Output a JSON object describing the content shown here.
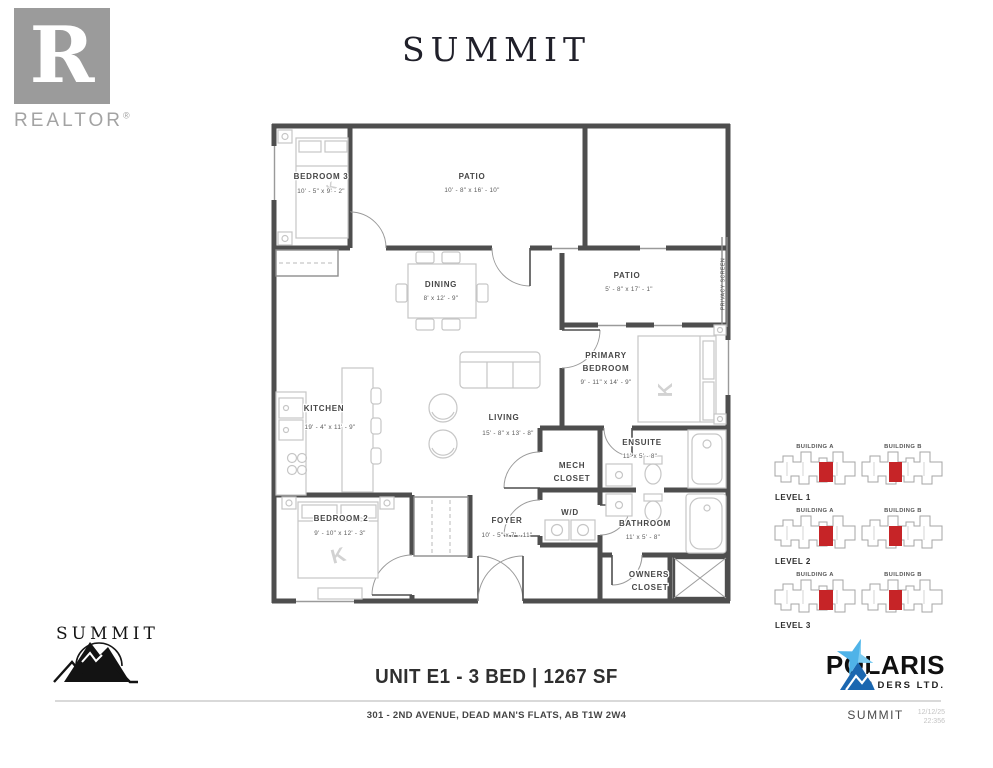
{
  "header": {
    "realtor": {
      "monogram": "R",
      "wordmark": "REALTOR",
      "registered": "®"
    },
    "title": "SUMMIT"
  },
  "colors": {
    "wall_gray": "#4e4e4e",
    "furniture_gray": "#c6c6c6",
    "realtor_gray": "#9b9b9b",
    "polaris_star_blue": "#4fb3e8",
    "polaris_mountain_blue": "#1b67b0"
  },
  "floor_plan": {
    "bed_mark": "K",
    "privacy_screen_label": "PRIVACY SCREEN",
    "rooms": {
      "bedroom3": {
        "name": "BEDROOM 3",
        "dims": "10' - 5\" x 9' - 2\""
      },
      "patio_top": {
        "name": "PATIO",
        "dims": "10' - 8\" x 16' - 10\""
      },
      "dining": {
        "name": "DINING",
        "dims": "8' x 12' - 9\""
      },
      "patio_side": {
        "name": "PATIO",
        "dims": "5' - 8\" x 17' - 1\""
      },
      "primary_bedroom": {
        "line1": "PRIMARY",
        "line2": "BEDROOM",
        "dims": "9' - 11\" x 14' - 9\""
      },
      "kitchen": {
        "name": "KITCHEN",
        "dims": "19' - 4\" x 11' - 9\""
      },
      "living": {
        "name": "LIVING",
        "dims": "15' - 8\" x 13' - 8\""
      },
      "ensuite": {
        "name": "ENSUITE",
        "dims": "11' x 5' - 8\""
      },
      "mech_closet": {
        "line1": "MECH",
        "line2": "CLOSET"
      },
      "wd": {
        "name": "W/D"
      },
      "bathroom": {
        "name": "BATHROOM",
        "dims": "11' x 5' - 8\""
      },
      "bedroom2": {
        "name": "BEDROOM 2",
        "dims": "9' - 10\" x 12' - 3\""
      },
      "foyer": {
        "name": "FOYER",
        "dims": "10' - 5\" x 7' - 11\""
      },
      "owners_closet": {
        "line1": "OWNERS",
        "line2": "CLOSET"
      }
    }
  },
  "key_plan": {
    "building_a_label": "BUILDING A",
    "building_b_label": "BUILDING B",
    "levels": [
      "LEVEL 1",
      "LEVEL 2",
      "LEVEL 3"
    ],
    "highlight_color": "#c62427"
  },
  "footer": {
    "brand_name": "SUMMIT",
    "unit_title": "UNIT E1 - 3 BED | 1267 SF",
    "address": "301 - 2ND AVENUE, DEAD MAN'S FLATS, AB T1W 2W4",
    "builder_name": "POLARIS",
    "builder_subtitle": "BUILDERS LTD.",
    "sheet": {
      "project": "SUMMIT",
      "date": "12/12/25",
      "number": "22:356"
    }
  }
}
